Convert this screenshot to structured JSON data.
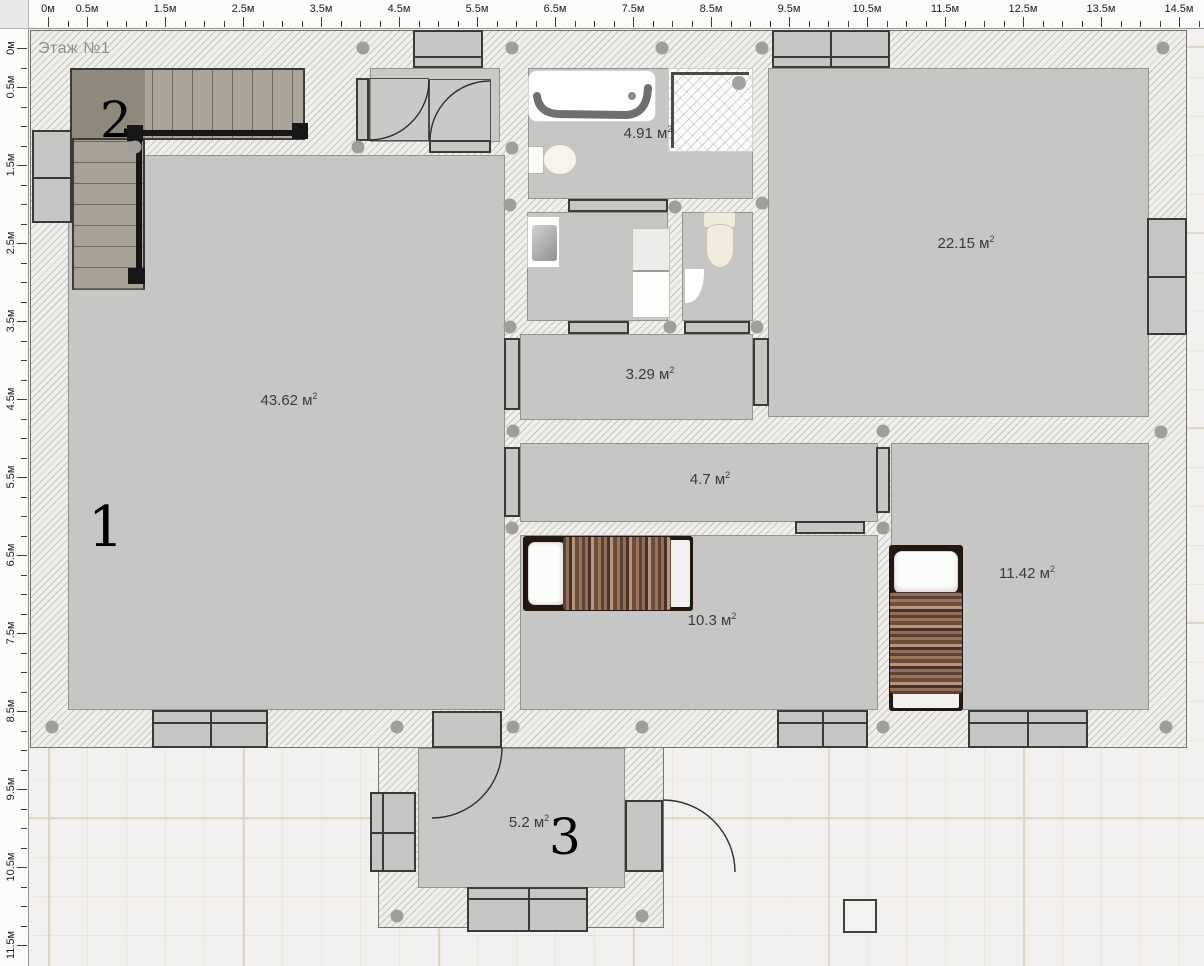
{
  "floor_plan": {
    "title": "Этаж №1",
    "unit": "м"
  },
  "rulers": {
    "origin": 48,
    "px_per_meter": 78,
    "minor_step": 19.5,
    "top": {
      "length": 1204,
      "labels": [
        {
          "t": "0м",
          "p": 48
        },
        {
          "t": "0.5м",
          "p": 87
        },
        {
          "t": "1.5м",
          "p": 165
        },
        {
          "t": "2.5м",
          "p": 243
        },
        {
          "t": "3.5м",
          "p": 321
        },
        {
          "t": "4.5м",
          "p": 399
        },
        {
          "t": "5.5м",
          "p": 477
        },
        {
          "t": "6.5м",
          "p": 555
        },
        {
          "t": "7.5м",
          "p": 633
        },
        {
          "t": "8.5м",
          "p": 711
        },
        {
          "t": "9.5м",
          "p": 789
        },
        {
          "t": "10.5м",
          "p": 867
        },
        {
          "t": "11.5м",
          "p": 945
        },
        {
          "t": "12.5м",
          "p": 1023
        },
        {
          "t": "13.5м",
          "p": 1101
        },
        {
          "t": "14.5м",
          "p": 1179
        }
      ]
    },
    "left": {
      "length": 966,
      "labels": [
        {
          "t": "0м",
          "p": 48
        },
        {
          "t": "0.5м",
          "p": 87
        },
        {
          "t": "1.5м",
          "p": 165
        },
        {
          "t": "2.5м",
          "p": 243
        },
        {
          "t": "3.5м",
          "p": 321
        },
        {
          "t": "4.5м",
          "p": 399
        },
        {
          "t": "5.5м",
          "p": 477
        },
        {
          "t": "6.5м",
          "p": 555
        },
        {
          "t": "7.5м",
          "p": 633
        },
        {
          "t": "8.5м",
          "p": 711
        },
        {
          "t": "9.5м",
          "p": 789
        },
        {
          "t": "10.5м",
          "p": 867
        },
        {
          "t": "11.5м",
          "p": 945
        }
      ]
    }
  },
  "rooms": {
    "living": {
      "area_text": "43.62 м",
      "area_sup": "2",
      "marker": "1"
    },
    "bedroom_large": {
      "area_text": "22.15 м",
      "area_sup": "2"
    },
    "bathroom": {
      "area_text": "4.91 м",
      "area_sup": "2"
    },
    "hallway_small": {
      "area_text": "3.29 м",
      "area_sup": "2"
    },
    "hallway": {
      "area_text": "4.7 м",
      "area_sup": "2"
    },
    "bedroom_mid": {
      "area_text": "10.3 м",
      "area_sup": "2"
    },
    "bedroom_corner": {
      "area_text": "11.42 м",
      "area_sup": "2"
    },
    "porch": {
      "area_text": "5.2 м",
      "area_sup": "2",
      "marker": "3"
    }
  },
  "stairs": {
    "marker": "2"
  },
  "dots": [
    [
      363,
      48
    ],
    [
      512,
      48
    ],
    [
      662,
      48
    ],
    [
      762,
      48
    ],
    [
      1163,
      48
    ],
    [
      135,
      147
    ],
    [
      358,
      147
    ],
    [
      512,
      148
    ],
    [
      510,
      205
    ],
    [
      675,
      207
    ],
    [
      762,
      203
    ],
    [
      510,
      327
    ],
    [
      670,
      327
    ],
    [
      757,
      327
    ],
    [
      513,
      431
    ],
    [
      883,
      431
    ],
    [
      1161,
      432
    ],
    [
      512,
      528
    ],
    [
      883,
      528
    ],
    [
      52,
      727
    ],
    [
      397,
      727
    ],
    [
      513,
      727
    ],
    [
      642,
      727
    ],
    [
      883,
      727
    ],
    [
      1166,
      727
    ],
    [
      397,
      916
    ],
    [
      642,
      916
    ]
  ],
  "colors": {
    "canvas_bg": "#f2f1ef",
    "grid_minor": "#e8e6df",
    "grid_major": "#d9d6c4",
    "wall_hatch": "#c8c6c1",
    "wall_fill": "#f0efec",
    "floor": "#c6c6c4",
    "frame_dark": "#3a3a38",
    "dot": "#9e9e9c",
    "label_text": "#3a3a3a",
    "bed_frame": "#231710",
    "blanket_browns": [
      "#5d4136",
      "#8f6f5c",
      "#49312a",
      "#b5977e",
      "#6d4c3c",
      "#997457"
    ]
  }
}
